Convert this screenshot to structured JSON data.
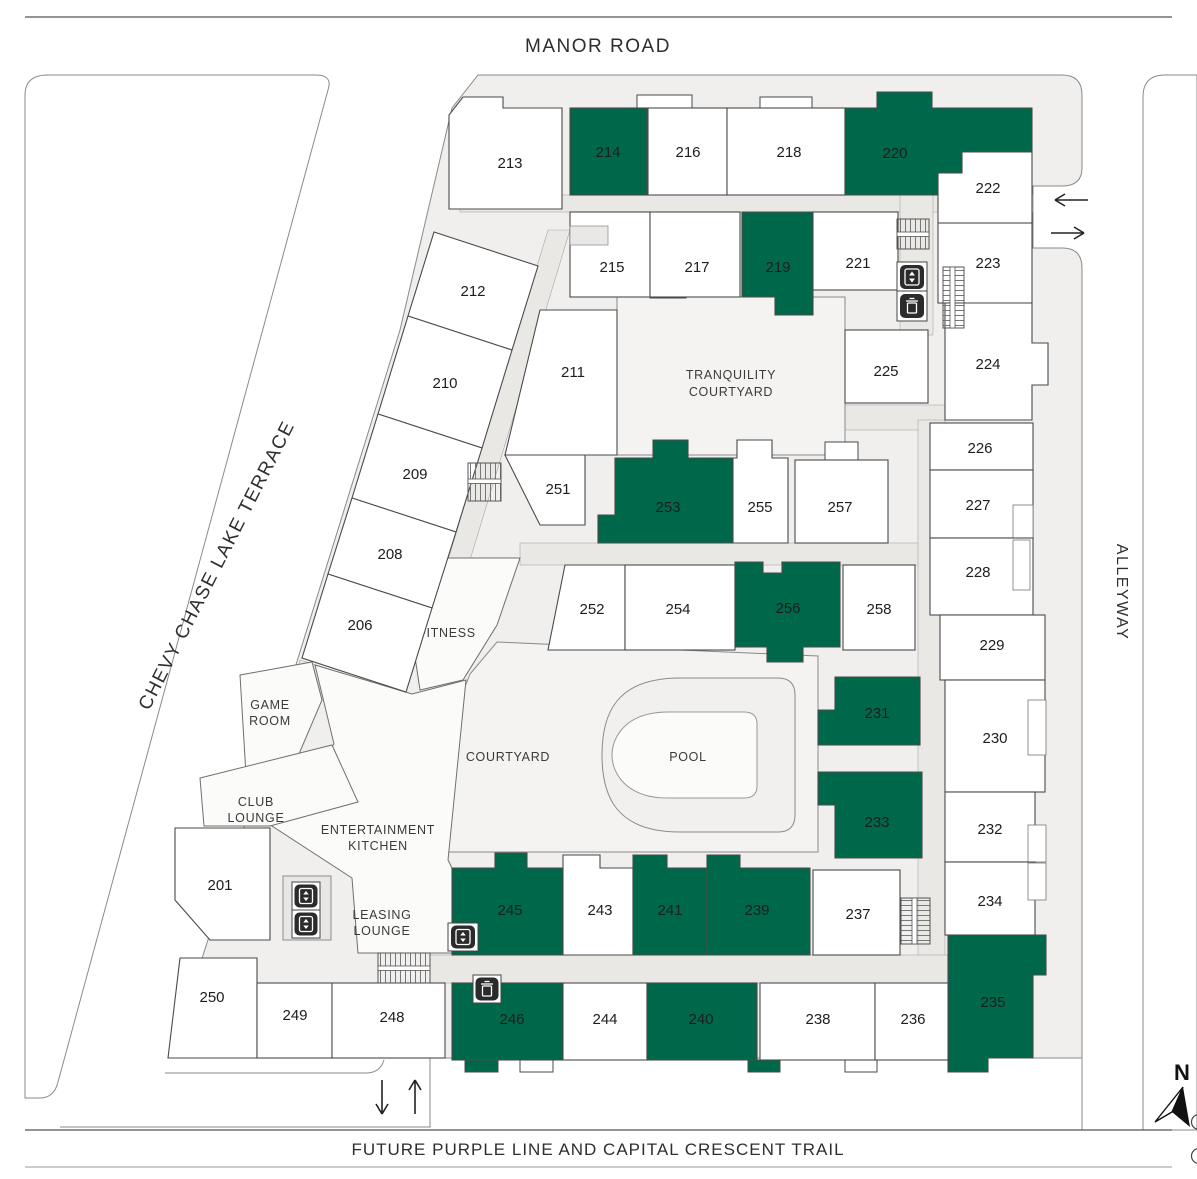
{
  "streets": {
    "top": "MANOR ROAD",
    "left": "CHEVY CHASE LAKE TERRACE",
    "right": "ALLEYWAY",
    "bottom": "FUTURE PURPLE LINE AND CAPITAL CRESCENT TRAIL"
  },
  "compass": {
    "label": "N"
  },
  "colors": {
    "highlight": "#00684a",
    "unit_fill": "#ffffff",
    "base": "#f0efed",
    "courtyard": "#f4f3f1",
    "pool": "#fbfbfa"
  },
  "icons": {
    "elevator": "elevator up/down",
    "trash": "trash chute",
    "stairs": "stairs",
    "entry_arrows": "one-way in/out arrows",
    "north": "north compass arrow"
  },
  "amenities": {
    "tranquility_courtyard": {
      "line1": "TRANQUILITY",
      "line2": "COURTYARD"
    },
    "fitness": {
      "line1": "FITNESS"
    },
    "game_room": {
      "line1": "GAME",
      "line2": "ROOM"
    },
    "club_lounge": {
      "line1": "CLUB",
      "line2": "LOUNGE"
    },
    "entertainment_kitchen": {
      "line1": "ENTERTAINMENT",
      "line2": "KITCHEN"
    },
    "leasing_lounge": {
      "line1": "LEASING",
      "line2": "LOUNGE"
    },
    "courtyard": {
      "line1": "COURTYARD"
    },
    "pool": {
      "line1": "POOL"
    }
  },
  "units": {
    "u201": {
      "number": "201",
      "highlighted": false
    },
    "u206": {
      "number": "206",
      "highlighted": false
    },
    "u208": {
      "number": "208",
      "highlighted": false
    },
    "u209": {
      "number": "209",
      "highlighted": false
    },
    "u210": {
      "number": "210",
      "highlighted": false
    },
    "u211": {
      "number": "211",
      "highlighted": false
    },
    "u212": {
      "number": "212",
      "highlighted": false
    },
    "u213": {
      "number": "213",
      "highlighted": false
    },
    "u214": {
      "number": "214",
      "highlighted": true
    },
    "u215": {
      "number": "215",
      "highlighted": false
    },
    "u216": {
      "number": "216",
      "highlighted": false
    },
    "u217": {
      "number": "217",
      "highlighted": false
    },
    "u218": {
      "number": "218",
      "highlighted": false
    },
    "u219": {
      "number": "219",
      "highlighted": true
    },
    "u220": {
      "number": "220",
      "highlighted": true
    },
    "u221": {
      "number": "221",
      "highlighted": false
    },
    "u222": {
      "number": "222",
      "highlighted": false
    },
    "u223": {
      "number": "223",
      "highlighted": false
    },
    "u224": {
      "number": "224",
      "highlighted": false
    },
    "u225": {
      "number": "225",
      "highlighted": false
    },
    "u226": {
      "number": "226",
      "highlighted": false
    },
    "u227": {
      "number": "227",
      "highlighted": false
    },
    "u228": {
      "number": "228",
      "highlighted": false
    },
    "u229": {
      "number": "229",
      "highlighted": false
    },
    "u230": {
      "number": "230",
      "highlighted": false
    },
    "u231": {
      "number": "231",
      "highlighted": true
    },
    "u232": {
      "number": "232",
      "highlighted": false
    },
    "u233": {
      "number": "233",
      "highlighted": true
    },
    "u234": {
      "number": "234",
      "highlighted": false
    },
    "u235": {
      "number": "235",
      "highlighted": true
    },
    "u236": {
      "number": "236",
      "highlighted": false
    },
    "u237": {
      "number": "237",
      "highlighted": false
    },
    "u238": {
      "number": "238",
      "highlighted": false
    },
    "u239": {
      "number": "239",
      "highlighted": true
    },
    "u240": {
      "number": "240",
      "highlighted": true
    },
    "u241": {
      "number": "241",
      "highlighted": true
    },
    "u243": {
      "number": "243",
      "highlighted": false
    },
    "u244": {
      "number": "244",
      "highlighted": false
    },
    "u245": {
      "number": "245",
      "highlighted": true
    },
    "u246": {
      "number": "246",
      "highlighted": true
    },
    "u248": {
      "number": "248",
      "highlighted": false
    },
    "u249": {
      "number": "249",
      "highlighted": false
    },
    "u250": {
      "number": "250",
      "highlighted": false
    },
    "u251": {
      "number": "251",
      "highlighted": false
    },
    "u252": {
      "number": "252",
      "highlighted": false
    },
    "u253": {
      "number": "253",
      "highlighted": true
    },
    "u254": {
      "number": "254",
      "highlighted": false
    },
    "u255": {
      "number": "255",
      "highlighted": false
    },
    "u256": {
      "number": "256",
      "highlighted": true
    },
    "u257": {
      "number": "257",
      "highlighted": false
    },
    "u258": {
      "number": "258",
      "highlighted": false
    }
  }
}
